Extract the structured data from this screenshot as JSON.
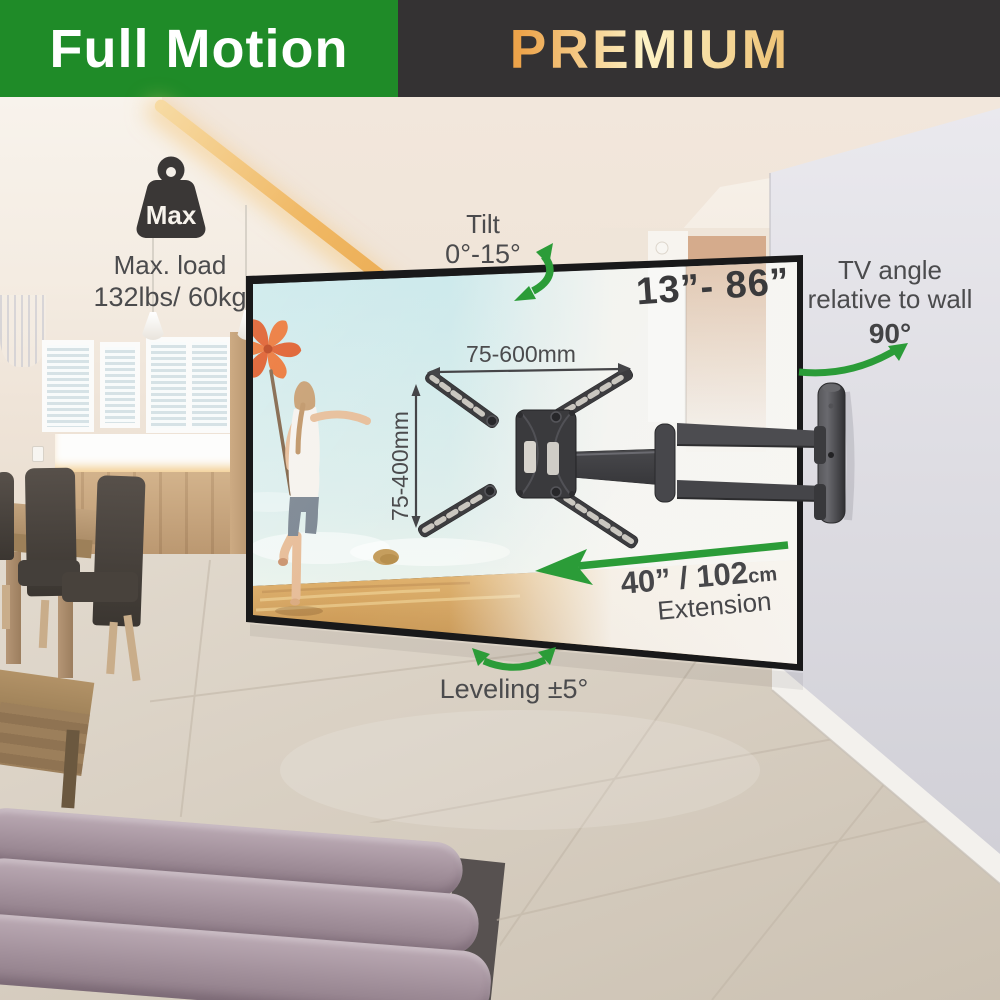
{
  "header": {
    "product_type": "Full Motion",
    "tier": "PREMIUM"
  },
  "colors": {
    "banner_green": "#1f8b28",
    "banner_dark": "#343233",
    "gold_light": "#fdf2c5",
    "gold_deep": "#eca34a",
    "arrow_green": "#2b9c38",
    "text_gray": "#4b4b4d"
  },
  "annotations": {
    "max_load": {
      "icon_text": "Max",
      "title": "Max. load",
      "value": "132lbs/ 60kg"
    },
    "tilt": {
      "title": "Tilt",
      "value": "0°-15°"
    },
    "screen_size": {
      "value": "13”- 86”"
    },
    "tv_angle": {
      "line1": "TV angle",
      "line2": "relative to wall",
      "value": "90°"
    },
    "vesa": {
      "width": "75-600mm",
      "height": "75-400mm"
    },
    "extension": {
      "imperial": "40”",
      "separator": " / ",
      "metric": "102",
      "metric_unit": "cm",
      "label": "Extension"
    },
    "leveling": {
      "value": "Leveling ±5°"
    }
  }
}
